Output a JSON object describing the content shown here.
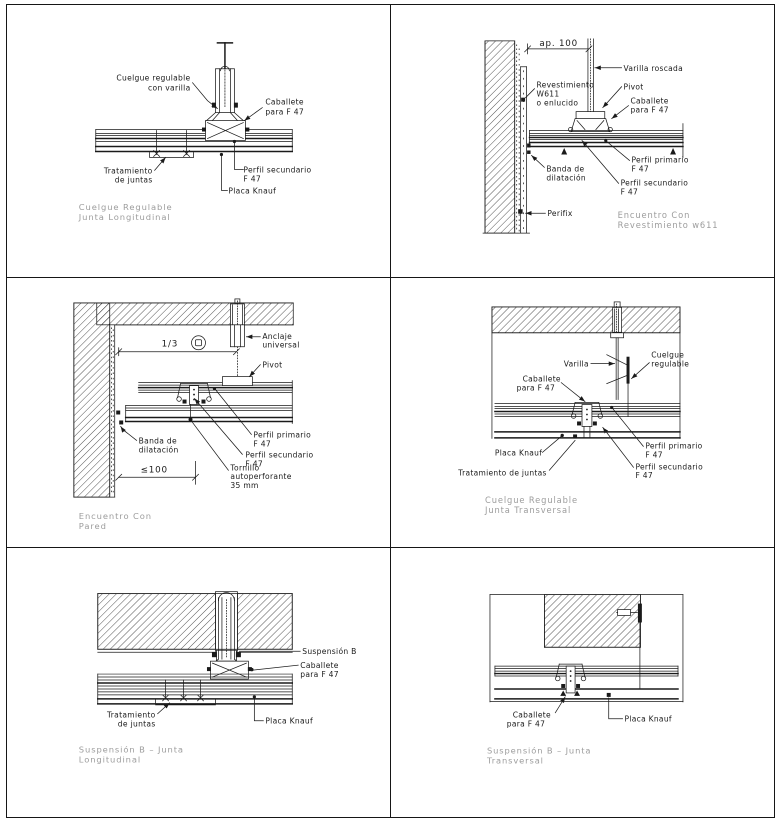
{
  "sheet": {
    "background": "#ffffff",
    "line_color": "#1a1a1a",
    "caption_color": "#9c9c9c"
  },
  "panels": [
    {
      "name": "cuelgue-regulable-junta-longitudinal",
      "caption": [
        "Cuelgue Regulable",
        "Junta Longitudinal"
      ],
      "labels": {
        "cuelgue_regulable": [
          "Cuelgue regulable",
          "con varilla"
        ],
        "caballete": [
          "Caballete",
          "para F 47"
        ],
        "tratamiento_juntas": [
          "Tratamiento",
          "de juntas"
        ],
        "perfil_secundario": [
          "Perfil secundario",
          "F 47"
        ],
        "placa_knauf": "Placa Knauf"
      }
    },
    {
      "name": "encuentro-con-revestimiento-w611",
      "caption": [
        "Encuentro Con",
        "Revestimiento w611"
      ],
      "dimension": "ap. 100",
      "labels": {
        "varilla_roscada": "Varilla roscada",
        "pivot": "Pivot",
        "caballete": [
          "Caballete",
          "para F 47"
        ],
        "revestimiento": [
          "Revestimiento",
          "W611",
          "o enlucido"
        ],
        "banda_dilatacion": [
          "Banda de",
          "dilatación"
        ],
        "perfil_primario": [
          "Perfil primario",
          "F 47"
        ],
        "perfil_secundario": [
          "Perfil secundario",
          "F 47"
        ],
        "perifix": "Perifix"
      }
    },
    {
      "name": "encuentro-con-pared",
      "caption": [
        "Encuentro Con",
        "Pared"
      ],
      "dimensions": {
        "modulacion": "1/3",
        "borde": "≤100"
      },
      "labels": {
        "anclaje_universal": [
          "Anclaje",
          "universal"
        ],
        "pivot": "Pivot",
        "perfil_primario": [
          "Perfil primario",
          "F 47"
        ],
        "perfil_secundario": [
          "Perfil secundario",
          "F 47"
        ],
        "banda_dilatacion": [
          "Banda de",
          "dilatación"
        ],
        "tornillo": [
          "Tornillo",
          "autoperforante",
          "35 mm"
        ]
      }
    },
    {
      "name": "cuelgue-regulable-junta-transversal",
      "caption": [
        "Cuelgue Regulable",
        "Junta Transversal"
      ],
      "labels": {
        "varilla": "Varilla",
        "cuelgue_regulable": [
          "Cuelgue",
          "regulable"
        ],
        "caballete": [
          "Caballete",
          "para F 47"
        ],
        "perfil_primario": [
          "Perfil primario",
          "F 47"
        ],
        "perfil_secundario": [
          "Perfil secundario",
          "F 47"
        ],
        "placa_knauf": "Placa Knauf",
        "tratamiento_juntas": "Tratamiento de juntas"
      }
    },
    {
      "name": "suspension-b-junta-longitudinal",
      "caption": [
        "Suspensión B – Junta",
        "Longitudinal"
      ],
      "labels": {
        "suspension_b": "Suspensión B",
        "caballete": [
          "Caballete",
          "para F 47"
        ],
        "tratamiento_juntas": [
          "Tratamiento",
          "de juntas"
        ],
        "placa_knauf": "Placa Knauf"
      }
    },
    {
      "name": "suspension-b-junta-transversal",
      "caption": [
        "Suspensión B – Junta",
        "Transversal"
      ],
      "labels": {
        "caballete": [
          "Caballete",
          "para F 47"
        ],
        "placa_knauf": "Placa Knauf"
      }
    }
  ]
}
